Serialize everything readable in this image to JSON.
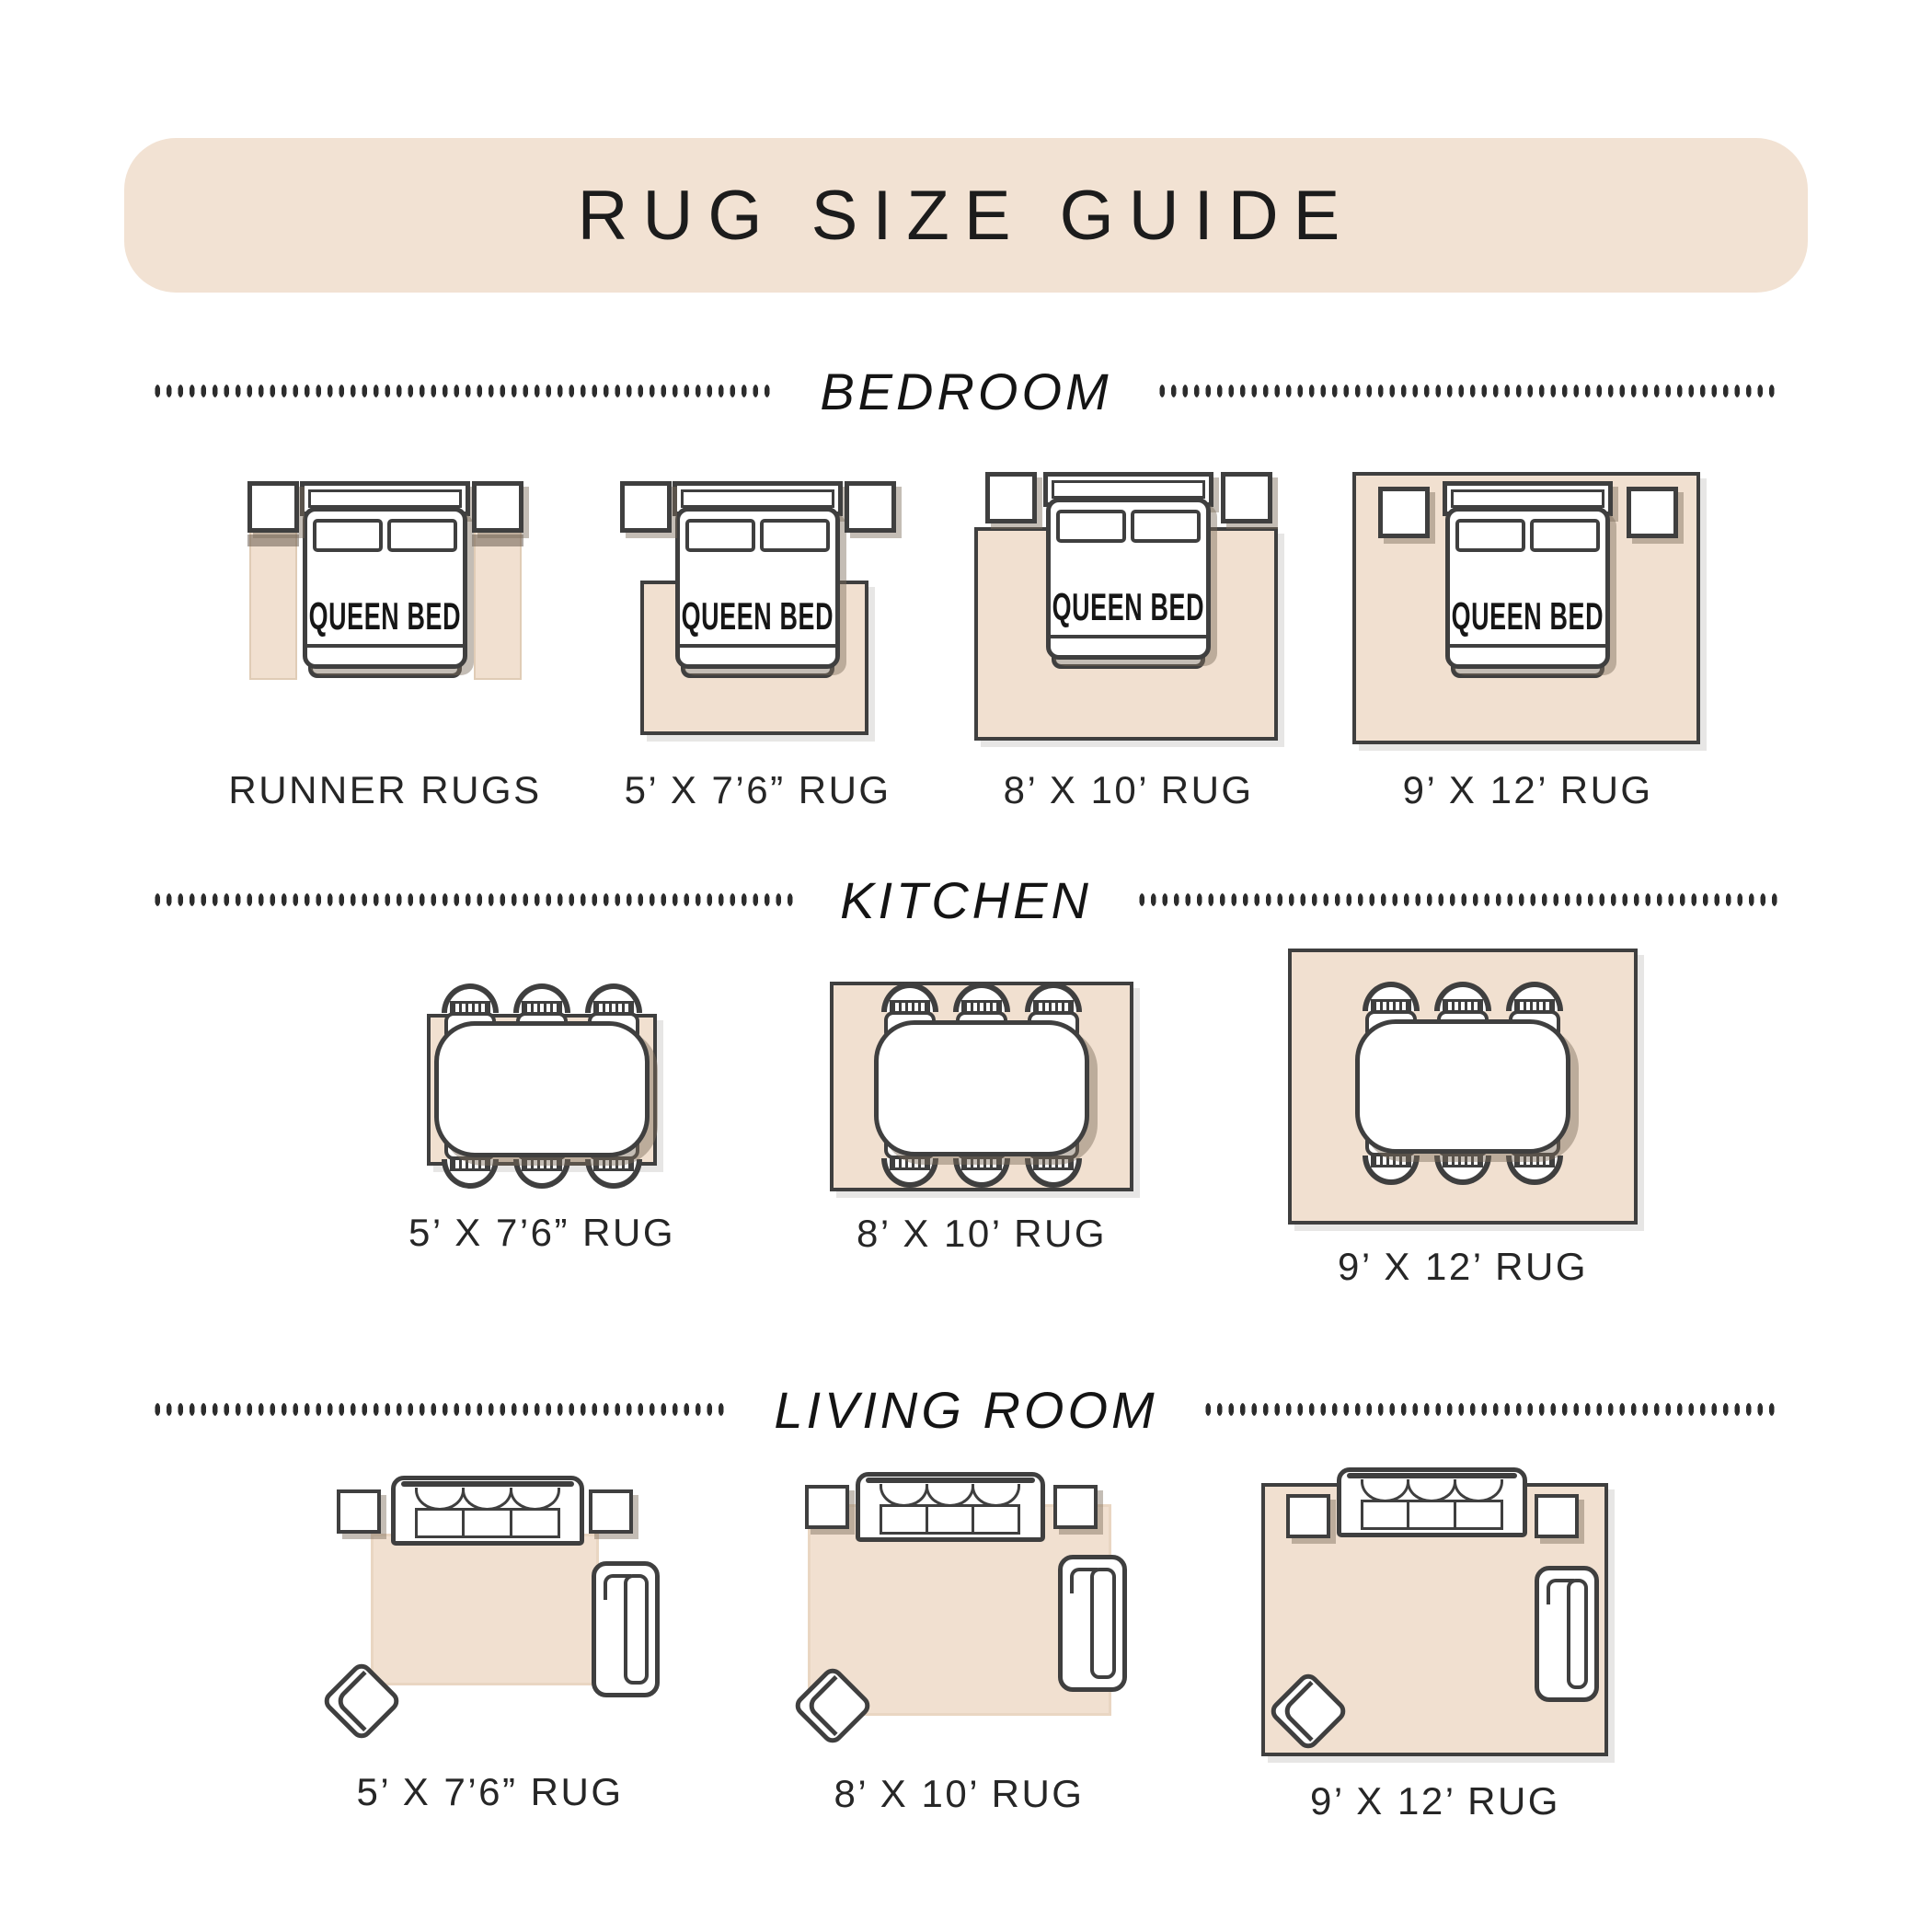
{
  "title": "RUG SIZE GUIDE",
  "colors": {
    "banner_fill": "#f2e2d3",
    "rug_fill": "#f1e0d0",
    "outline": "#3f3f3f",
    "furniture_shadow": "rgba(125,108,92,0.45)",
    "divider_dots": "#2c2c2c",
    "label_text": "#262626"
  },
  "sections": [
    {
      "name": "BEDROOM",
      "figures": [
        {
          "label": "RUNNER RUGS",
          "furniture_label": "QUEEN BED",
          "variant": "runner-rugs-beside-bed"
        },
        {
          "label": "5’ X 7’6” RUG",
          "furniture_label": "QUEEN BED",
          "variant": "rug-under-lower-bed"
        },
        {
          "label": "8’ X 10’ RUG",
          "furniture_label": "QUEEN BED",
          "variant": "rug-under-bed-below-nightstands"
        },
        {
          "label": "9’ X 12’ RUG",
          "furniture_label": "QUEEN BED",
          "variant": "rug-under-bed-and-nightstands"
        }
      ]
    },
    {
      "name": "KITCHEN",
      "figures": [
        {
          "label": "5’ X 7’6” RUG",
          "variant": "table-chairs-overhang"
        },
        {
          "label": "8’ X 10’ RUG",
          "variant": "table-chairs-on-rug"
        },
        {
          "label": "9’ X 12’ RUG",
          "variant": "table-chairs-on-rug-large"
        }
      ]
    },
    {
      "name": "LIVING ROOM",
      "figures": [
        {
          "label": "5’ X 7’6” RUG",
          "variant": "sofa-front-legs-on-rug"
        },
        {
          "label": "8’ X 10’ RUG",
          "variant": "most-furniture-on-rug"
        },
        {
          "label": "9’ X 12’ RUG",
          "variant": "all-furniture-on-rug"
        }
      ]
    }
  ]
}
